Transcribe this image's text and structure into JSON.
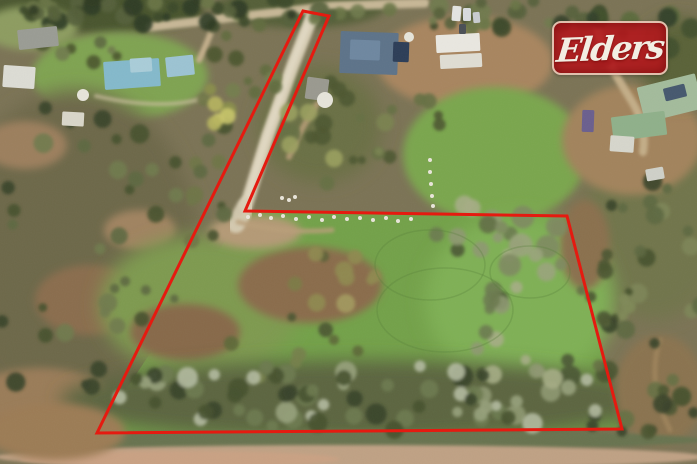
{
  "photo": {
    "kind": "aerial-property-photo",
    "width": 697,
    "height": 464
  },
  "logo": {
    "text": "Elders",
    "x": 552,
    "y": 21,
    "width": 116,
    "height": 54,
    "bg_color": "rgba(178,24,29,0.9)",
    "border_color": "rgba(235,221,200,0.85)",
    "text_color": "#f2eee3",
    "font_size": 33
  },
  "boundary": {
    "color": "#e51a10",
    "stroke_width": 3,
    "points": [
      [
        303,
        11
      ],
      [
        329,
        16
      ],
      [
        245,
        211
      ],
      [
        567,
        216
      ],
      [
        622,
        429
      ],
      [
        97,
        433
      ]
    ]
  },
  "scene": {
    "base_color": "#7b7355",
    "terrain": [
      {
        "type": "ellipse",
        "x": 90,
        "y": 10,
        "rx": 115,
        "ry": 24,
        "fill": "#4a552f",
        "blur": 2
      },
      {
        "type": "ellipse",
        "x": 300,
        "y": 8,
        "rx": 85,
        "ry": 20,
        "fill": "#545f37",
        "blur": 2
      },
      {
        "type": "ellipse",
        "x": 30,
        "y": 28,
        "rx": 48,
        "ry": 22,
        "fill": "#8d9c60",
        "blur": 2
      },
      {
        "type": "ellipse",
        "x": 120,
        "y": 76,
        "rx": 88,
        "ry": 44,
        "fill": "#7fa351",
        "blur": 2
      },
      {
        "type": "ellipse",
        "x": 75,
        "y": 255,
        "rx": 125,
        "ry": 165,
        "fill": "#6d684a",
        "blur": 3
      },
      {
        "type": "ellipse",
        "x": 25,
        "y": 145,
        "rx": 42,
        "ry": 24,
        "fill": "#9c7f5d",
        "blur": 2
      },
      {
        "type": "ellipse",
        "x": 90,
        "y": 300,
        "rx": 55,
        "ry": 35,
        "fill": "#8a6d4d",
        "blur": 2
      },
      {
        "type": "ellipse",
        "x": 40,
        "y": 398,
        "rx": 70,
        "ry": 30,
        "fill": "#9a7c58",
        "blur": 2
      },
      {
        "type": "ellipse",
        "x": 140,
        "y": 230,
        "rx": 36,
        "ry": 20,
        "fill": "#a08360",
        "blur": 2
      },
      {
        "type": "ellipse",
        "x": 320,
        "y": 125,
        "rx": 62,
        "ry": 58,
        "fill": "#6b6f45",
        "blur": 3
      },
      {
        "type": "ellipse",
        "x": 465,
        "y": 62,
        "rx": 88,
        "ry": 46,
        "fill": "#a8855f",
        "blur": 2
      },
      {
        "type": "ellipse",
        "x": 495,
        "y": 155,
        "rx": 92,
        "ry": 68,
        "fill": "#7aa64e",
        "blur": 2
      },
      {
        "type": "ellipse",
        "x": 655,
        "y": 225,
        "rx": 72,
        "ry": 95,
        "fill": "#71744c",
        "blur": 3
      },
      {
        "type": "ellipse",
        "x": 632,
        "y": 140,
        "rx": 70,
        "ry": 55,
        "fill": "#a2835c",
        "blur": 2
      },
      {
        "type": "ellipse",
        "x": 680,
        "y": 60,
        "rx": 42,
        "ry": 42,
        "fill": "#5a6238",
        "blur": 3
      },
      {
        "type": "poly",
        "points": [
          [
            245,
            211
          ],
          [
            567,
            216
          ],
          [
            622,
            429
          ],
          [
            97,
            433
          ]
        ],
        "fill": "#73a149",
        "blur": 0
      },
      {
        "type": "ellipse",
        "x": 520,
        "y": 300,
        "rx": 95,
        "ry": 85,
        "fill": "#7fb054",
        "blur": 3
      },
      {
        "type": "ellipse",
        "x": 200,
        "y": 305,
        "rx": 100,
        "ry": 70,
        "fill": "#7e9a4f",
        "blur": 3
      },
      {
        "type": "ellipse",
        "x": 310,
        "y": 285,
        "rx": 72,
        "ry": 38,
        "fill": "#8a6c4b",
        "blur": 2
      },
      {
        "type": "ellipse",
        "x": 185,
        "y": 332,
        "rx": 55,
        "ry": 28,
        "fill": "#87694a",
        "blur": 2
      },
      {
        "type": "ellipse",
        "x": 255,
        "y": 232,
        "rx": 46,
        "ry": 17,
        "fill": "#b49a76",
        "blur": 2
      },
      {
        "type": "ellipse",
        "x": 585,
        "y": 245,
        "rx": 25,
        "ry": 45,
        "fill": "#8a6f4e",
        "blur": 2
      },
      {
        "type": "ellipse",
        "x": 360,
        "y": 400,
        "rx": 300,
        "ry": 40,
        "fill": "#5c6540",
        "blur": 3
      },
      {
        "type": "ellipse",
        "x": 660,
        "y": 390,
        "rx": 45,
        "ry": 55,
        "fill": "#8a7350",
        "blur": 2
      },
      {
        "type": "ellipse",
        "x": 350,
        "y": 440,
        "rx": 355,
        "ry": 10,
        "fill": "#67734f",
        "blur": 1
      },
      {
        "type": "ellipse",
        "x": 350,
        "y": 457,
        "rx": 355,
        "ry": 12,
        "fill": "#bfa184",
        "blur": 1
      },
      {
        "type": "ellipse",
        "x": 180,
        "y": 459,
        "rx": 160,
        "ry": 8,
        "fill": "#c9a183",
        "blur": 1
      },
      {
        "type": "ellipse",
        "x": 55,
        "y": 432,
        "rx": 70,
        "ry": 28,
        "fill": "#9c7c55",
        "blur": 2
      }
    ],
    "roads": [
      {
        "d": "M 150,27 L 235,17 L 332,6 L 425,3",
        "stroke": "#c7b796",
        "w": 9,
        "blur": 1,
        "op": 1
      },
      {
        "d": "M 214,24 C 209,38 205,48 199,60",
        "stroke": "#c2ae8a",
        "w": 6,
        "blur": 1,
        "op": 1
      },
      {
        "d": "M 313,14 L 293,65 L 268,135 L 246,206",
        "stroke": "#d6ccb3",
        "w": 13,
        "blur": 1,
        "op": 1
      },
      {
        "d": "M 311,16 L 290,70 L 266,138 L 247,200",
        "stroke": "#e3dbc6",
        "w": 6,
        "blur": 1,
        "op": 0.8
      },
      {
        "d": "M 246,206 L 236,224",
        "stroke": "#d8cfb6",
        "w": 18,
        "blur": 1,
        "op": 0.9
      },
      {
        "d": "M 238,222 C 268,230 300,233 332,230",
        "stroke": "#b99f79",
        "w": 5,
        "blur": 1,
        "op": 0.8
      },
      {
        "d": "M 597,24 C 601,55 616,75 631,100 C 641,116 646,132 643,152",
        "stroke": "#c3ad87",
        "w": 8,
        "blur": 1,
        "op": 1
      },
      {
        "d": "M 289,157 C 299,132 309,117 317,104",
        "stroke": "#b79d77",
        "w": 6,
        "blur": 1,
        "op": 0.85
      },
      {
        "d": "M 96,96 C 130,104 170,108 205,98",
        "stroke": "#cabd9e",
        "w": 4,
        "blur": 1,
        "op": 0.7
      },
      {
        "d": "M 660,340 C 650,370 655,400 670,430",
        "stroke": "#a98c62",
        "w": 5,
        "blur": 1,
        "op": 0.6
      }
    ],
    "tree_clusters": [
      {
        "cx": 170,
        "cy": 12,
        "sx": 175,
        "sy": 17,
        "n": 48,
        "rmin": 4,
        "rmax": 10,
        "seed": 11,
        "colors": [
          "#3c4829",
          "#55613a",
          "#2f3a22",
          "#6a7547"
        ]
      },
      {
        "cx": 480,
        "cy": 14,
        "sx": 125,
        "sy": 17,
        "n": 26,
        "rmin": 4,
        "rmax": 10,
        "seed": 22,
        "colors": [
          "#3c4829",
          "#55613a",
          "#6a7547",
          "#707a4e"
        ]
      },
      {
        "cx": 625,
        "cy": 35,
        "sx": 75,
        "sy": 28,
        "n": 16,
        "rmin": 5,
        "rmax": 11,
        "seed": 33,
        "colors": [
          "#41502c",
          "#5a6a3c",
          "#33402a"
        ]
      },
      {
        "cx": 70,
        "cy": 48,
        "sx": 60,
        "sy": 20,
        "n": 10,
        "rmin": 4,
        "rmax": 9,
        "seed": 44,
        "colors": [
          "#4a552f",
          "#5d6840",
          "#707a4c"
        ]
      },
      {
        "cx": 70,
        "cy": 250,
        "sx": 115,
        "sy": 155,
        "n": 40,
        "rmin": 4,
        "rmax": 10,
        "seed": 55,
        "colors": [
          "#45512c",
          "#5d6840",
          "#38432a",
          "#707a4c"
        ]
      },
      {
        "cx": 190,
        "cy": 168,
        "sx": 55,
        "sy": 78,
        "n": 14,
        "rmin": 4,
        "rmax": 9,
        "seed": 66,
        "colors": [
          "#45512c",
          "#5d6840",
          "#6e7647"
        ]
      },
      {
        "cx": 332,
        "cy": 132,
        "sx": 55,
        "sy": 55,
        "n": 14,
        "rmin": 4,
        "rmax": 10,
        "seed": 77,
        "colors": [
          "#4c5630",
          "#657042",
          "#9aa05e"
        ]
      },
      {
        "cx": 215,
        "cy": 106,
        "sx": 26,
        "sy": 20,
        "n": 6,
        "rmin": 5,
        "rmax": 9,
        "seed": 88,
        "colors": [
          "#b7b55e",
          "#c8c46a",
          "#8a8f4a"
        ]
      },
      {
        "cx": 253,
        "cy": 60,
        "sx": 40,
        "sy": 40,
        "n": 10,
        "rmin": 4,
        "rmax": 9,
        "seed": 201,
        "colors": [
          "#4a552f",
          "#606b3e",
          "#747e4c"
        ]
      },
      {
        "cx": 330,
        "cy": 280,
        "sx": 46,
        "sy": 30,
        "n": 10,
        "rmin": 5,
        "rmax": 10,
        "seed": 99,
        "colors": [
          "#7c7c45",
          "#8f8a50",
          "#5d6336",
          "#a39a5e"
        ]
      },
      {
        "cx": 300,
        "cy": 345,
        "sx": 90,
        "sy": 38,
        "n": 8,
        "rmin": 4,
        "rmax": 8,
        "seed": 111,
        "colors": [
          "#5d6838",
          "#76804a",
          "#4a5530"
        ]
      },
      {
        "cx": 480,
        "cy": 255,
        "sx": 55,
        "sy": 62,
        "n": 16,
        "rmin": 5,
        "rmax": 11,
        "seed": 121,
        "colors": [
          "#8e9871",
          "#6b7a4f",
          "#4a5733",
          "#a5ad85"
        ]
      },
      {
        "cx": 520,
        "cy": 360,
        "sx": 55,
        "sy": 62,
        "n": 16,
        "rmin": 5,
        "rmax": 11,
        "seed": 131,
        "colors": [
          "#8e9871",
          "#6b7a4f",
          "#4a5733",
          "#a5ad85"
        ]
      },
      {
        "cx": 527,
        "cy": 243,
        "sx": 48,
        "sy": 36,
        "n": 12,
        "rmin": 6,
        "rmax": 12,
        "seed": 141,
        "colors": [
          "#7e8a60",
          "#5f6e42",
          "#9aa47c"
        ]
      },
      {
        "cx": 360,
        "cy": 398,
        "sx": 285,
        "sy": 34,
        "n": 62,
        "rmin": 5,
        "rmax": 11,
        "seed": 151,
        "colors": [
          "#97a17b",
          "#6d7a50",
          "#46512f",
          "#b3baa0",
          "#39432a"
        ]
      },
      {
        "cx": 655,
        "cy": 265,
        "sx": 60,
        "sy": 92,
        "n": 20,
        "rmin": 4,
        "rmax": 10,
        "seed": 161,
        "colors": [
          "#45512c",
          "#5d6840",
          "#38432a",
          "#7d8557"
        ]
      },
      {
        "cx": 640,
        "cy": 405,
        "sx": 58,
        "sy": 42,
        "n": 14,
        "rmin": 5,
        "rmax": 10,
        "seed": 171,
        "colors": [
          "#4a5530",
          "#657043",
          "#39432a"
        ]
      },
      {
        "cx": 400,
        "cy": 122,
        "sx": 42,
        "sy": 46,
        "n": 10,
        "rmin": 4,
        "rmax": 9,
        "seed": 181,
        "colors": [
          "#4c5630",
          "#657042",
          "#7a8350"
        ]
      },
      {
        "cx": 600,
        "cy": 305,
        "sx": 30,
        "sy": 70,
        "n": 12,
        "rmin": 4,
        "rmax": 9,
        "seed": 191,
        "colors": [
          "#4a5530",
          "#657043",
          "#808a58"
        ]
      }
    ],
    "tracks": {
      "stroke": "#567f38",
      "w": 1.5,
      "op": 0.3,
      "items": [
        {
          "x": 430,
          "y": 265,
          "rx": 55,
          "ry": 35
        },
        {
          "x": 445,
          "y": 310,
          "rx": 68,
          "ry": 42
        },
        {
          "x": 530,
          "y": 272,
          "rx": 40,
          "ry": 26
        }
      ]
    },
    "buildings": [
      {
        "name": "grey-roof-house",
        "x": 18,
        "y": 28,
        "w": 40,
        "h": 20,
        "rot": -6,
        "fill": "#9a9c94"
      },
      {
        "name": "white-marquee",
        "x": 3,
        "y": 66,
        "w": 32,
        "h": 22,
        "rot": 4,
        "fill": "#dcdcd4"
      },
      {
        "name": "blue-roof-house",
        "x": 104,
        "y": 60,
        "w": 56,
        "h": 28,
        "rot": -4,
        "fill": "#84b9cb"
      },
      {
        "name": "blue-roof-section",
        "x": 130,
        "y": 58,
        "w": 22,
        "h": 14,
        "rot": -4,
        "fill": "#a9ccd8"
      },
      {
        "name": "blue-shed",
        "x": 166,
        "y": 56,
        "w": 28,
        "h": 20,
        "rot": -6,
        "fill": "#9cc3d2"
      },
      {
        "name": "small-white-shed",
        "x": 62,
        "y": 112,
        "w": 22,
        "h": 14,
        "rot": 3,
        "fill": "#d9d6c9"
      },
      {
        "name": "dark-roof-house",
        "x": 340,
        "y": 32,
        "w": 58,
        "h": 42,
        "rot": 2,
        "fill": "#5d7389"
      },
      {
        "name": "dark-roof-upper",
        "x": 350,
        "y": 40,
        "w": 30,
        "h": 20,
        "rot": 2,
        "fill": "#6e87a0"
      },
      {
        "name": "solar-panels",
        "x": 393,
        "y": 42,
        "w": 16,
        "h": 20,
        "rot": 2,
        "fill": "#2c3d57"
      },
      {
        "name": "grey-shed",
        "x": 306,
        "y": 78,
        "w": 22,
        "h": 22,
        "rot": 8,
        "fill": "#9a998f"
      },
      {
        "name": "concrete-slab-1",
        "x": 436,
        "y": 34,
        "w": 44,
        "h": 18,
        "rot": -3,
        "fill": "#e9e7e0"
      },
      {
        "name": "concrete-slab-2",
        "x": 440,
        "y": 54,
        "w": 42,
        "h": 14,
        "rot": -3,
        "fill": "#dfddd3"
      },
      {
        "name": "vehicle-1",
        "x": 452,
        "y": 6,
        "w": 9,
        "h": 15,
        "rot": 5,
        "fill": "#e3e3e1"
      },
      {
        "name": "vehicle-2",
        "x": 463,
        "y": 8,
        "w": 8,
        "h": 13,
        "rot": 0,
        "fill": "#d8dadd"
      },
      {
        "name": "vehicle-3",
        "x": 473,
        "y": 12,
        "w": 7,
        "h": 11,
        "rot": -5,
        "fill": "#c8ccd0"
      },
      {
        "name": "vehicle-4",
        "x": 459,
        "y": 24,
        "w": 7,
        "h": 10,
        "rot": 0,
        "fill": "#4a4f55"
      },
      {
        "name": "green-roof-house",
        "x": 640,
        "y": 80,
        "w": 60,
        "h": 36,
        "rot": -14,
        "fill": "#a3bb9b"
      },
      {
        "name": "green-roof-solar",
        "x": 664,
        "y": 86,
        "w": 22,
        "h": 13,
        "rot": -14,
        "fill": "#46586e"
      },
      {
        "name": "long-green-shed",
        "x": 612,
        "y": 114,
        "w": 54,
        "h": 24,
        "rot": -7,
        "fill": "#8fb08a"
      },
      {
        "name": "white-caravan",
        "x": 610,
        "y": 136,
        "w": 24,
        "h": 16,
        "rot": 4,
        "fill": "#d6d6cc"
      },
      {
        "name": "purple-trailer",
        "x": 582,
        "y": 110,
        "w": 12,
        "h": 22,
        "rot": 2,
        "fill": "#6a5f8e"
      },
      {
        "name": "white-debris",
        "x": 646,
        "y": 168,
        "w": 18,
        "h": 12,
        "rot": -10,
        "fill": "#cfd0c8"
      }
    ],
    "tanks": {
      "fill": "#e6e4da",
      "items": [
        {
          "x": 325,
          "y": 100,
          "r": 8
        },
        {
          "x": 409,
          "y": 37,
          "r": 5
        },
        {
          "x": 83,
          "y": 95,
          "r": 6
        }
      ]
    },
    "sheep": {
      "r": 2,
      "fill": "#e9e5da",
      "items": [
        [
          248,
          217
        ],
        [
          260,
          215
        ],
        [
          271,
          218
        ],
        [
          283,
          216
        ],
        [
          296,
          219
        ],
        [
          309,
          217
        ],
        [
          322,
          220
        ],
        [
          334,
          217
        ],
        [
          347,
          219
        ],
        [
          360,
          218
        ],
        [
          373,
          220
        ],
        [
          386,
          218
        ],
        [
          398,
          221
        ],
        [
          411,
          219
        ],
        [
          282,
          198
        ],
        [
          289,
          200
        ],
        [
          295,
          197
        ],
        [
          430,
          160
        ],
        [
          430,
          172
        ],
        [
          431,
          184
        ],
        [
          432,
          196
        ],
        [
          433,
          206
        ]
      ]
    }
  }
}
